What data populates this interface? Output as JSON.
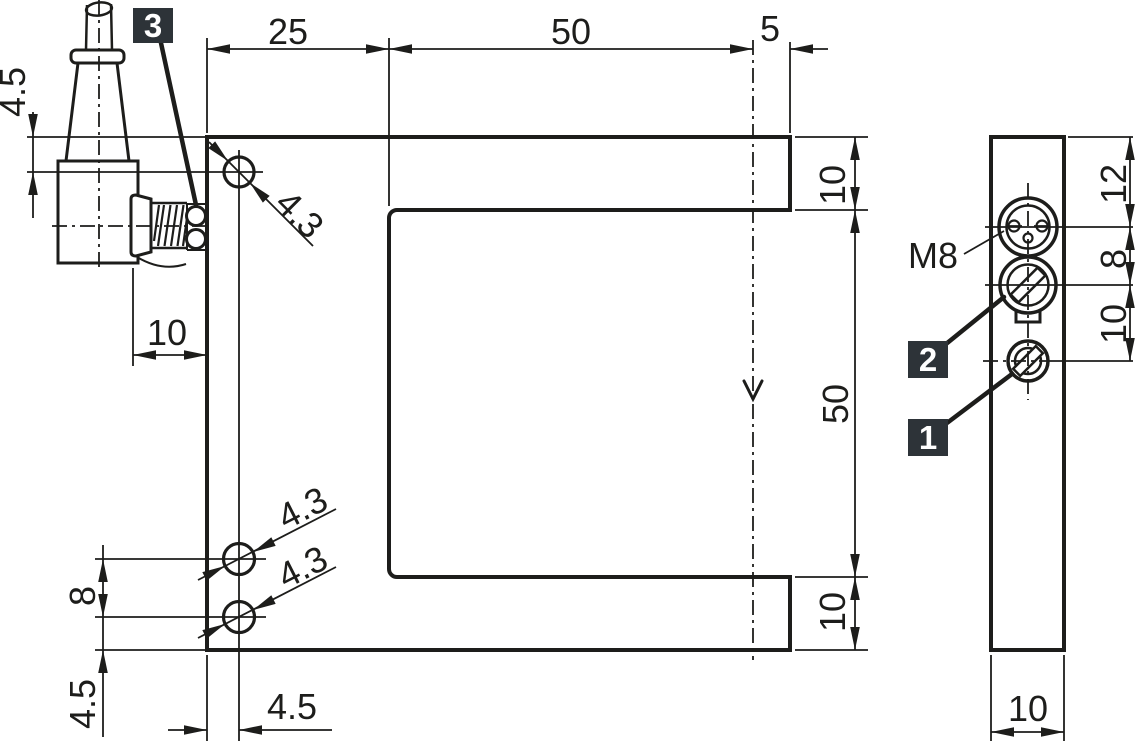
{
  "drawing": {
    "type": "dimensional-drawing",
    "views": [
      "front-view-fork-sensor",
      "side-view"
    ],
    "units": "mm"
  },
  "dims": {
    "top_25": "25",
    "top_50": "50",
    "top_5": "5",
    "left_cable_offset": "4.5",
    "left_gland_length": "10",
    "left_hole_pitch": "8",
    "left_hole_bottom_offset": "4.5",
    "bottom_hole_left_offset": "4.5",
    "right_arm_top": "10",
    "right_slot_height": "50",
    "right_arm_bottom": "10",
    "hole_dia_top": "4.3",
    "hole_dia_mid": "4.3",
    "hole_dia_low": "4.3",
    "side_top_to_connector": "12",
    "side_connector_to_pot": "8",
    "side_pot_to_screw": "10",
    "side_width": "10"
  },
  "labels": {
    "connector_thread": "M8",
    "badge_1": "1",
    "badge_2": "2",
    "badge_3": "3"
  },
  "colors": {
    "line": "#1d1d1b",
    "badge_bg": "#2d3338",
    "badge_text": "#ffffff",
    "background": "#ffffff"
  }
}
